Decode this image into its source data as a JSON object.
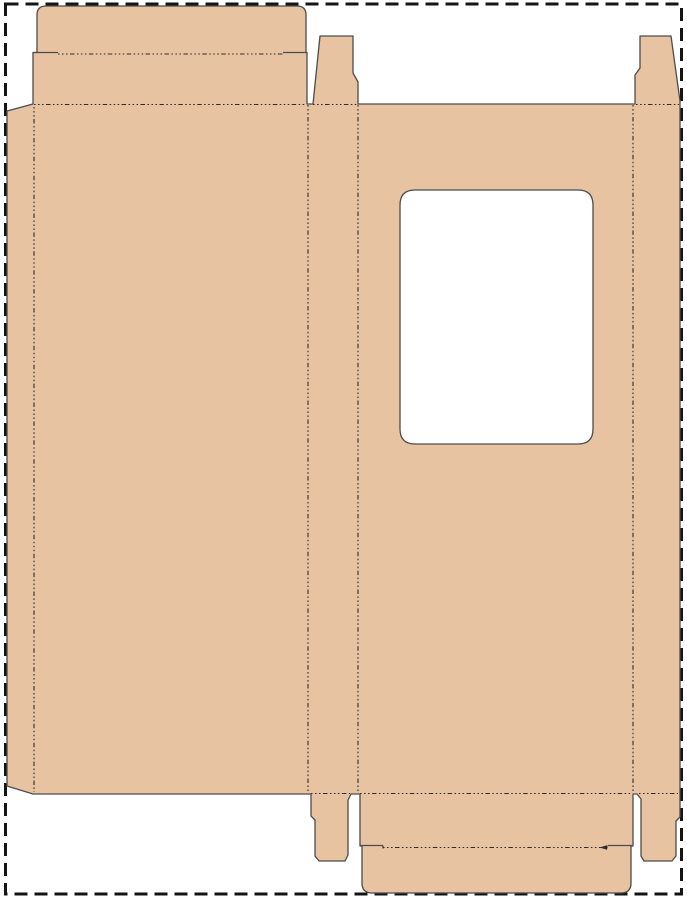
{
  "canvas": {
    "width": 687,
    "height": 900,
    "background_color": "#ffffff"
  },
  "palette": {
    "board_fill": "#e8c3a2",
    "cut_line": "#4c4c4c",
    "fold_line": "#2d2d2d",
    "page_border": "#141414",
    "window_fill": "#ffffff"
  },
  "page_border": {
    "x": 5.5,
    "y": 4,
    "width": 676,
    "height": 890,
    "stroke_width": 3,
    "dash_pattern": "13 7"
  },
  "dieline": {
    "outline_path": "M7,111 L33,104 L33,52.5 L37,52.5 L37,15 Q37,6 46,6 L297,6 Q306,6 306,15 L306,52.5 L307,52.5 L307,104 L313,104 L320,36 L353,36 L353,73 L358,82 L358,104 L635,104 L635,75 L640,68 L640,36 L671,36 L680,101 L680,817 L676,821 L676,856 L672,861 L644,861 L641,856 L641,799 L637,794 L633,794 L633,846 L631,846 L631,883 Q631,893 621,893 L372,893 Q362,893 362,883 L362,846 L360,846 L360,794 L351,794 L348,800 L348,855 L345,861 L319,861 L315,856 L315,820 L311,816 L311,794 L33,794 L7,786 Z",
    "window_cutout": {
      "x": 400,
      "y": 190,
      "width": 193,
      "height": 254,
      "corner_radius": 15
    },
    "cut_stroke_width": 1.3,
    "fold_stroke_width": 1.1,
    "fold_dash_pattern": "1.6 2.4 1.6 2.4 1.6 2.4 4.5 2.4",
    "cut_segments": [
      {
        "name": "tuck-top-left-shoulder",
        "d": "M33,52.5 H58"
      },
      {
        "name": "tuck-top-right-shoulder",
        "d": "M283,52.5 H306"
      },
      {
        "name": "tuck-bottom-left-ear",
        "d": "M360,845.5 H383"
      },
      {
        "name": "tuck-bottom-right-ear",
        "d": "M608,845.5 H632"
      },
      {
        "name": "tuck-bottom-left-tick",
        "d": "M383,845.5 V848.5"
      },
      {
        "name": "tuck-bottom-right-tick",
        "d": "M607,845.5 V848.5"
      }
    ],
    "fold_lines": [
      {
        "name": "glue-flap-fold",
        "d": "M34,107 V792"
      },
      {
        "name": "back-left-side-fold",
        "d": "M308,105 V792"
      },
      {
        "name": "left-side-front-fold",
        "d": "M358,105 V792"
      },
      {
        "name": "front-right-side-fold",
        "d": "M633,105 V792"
      },
      {
        "name": "top-tuck-flap-fold",
        "d": "M58,54 H283"
      },
      {
        "name": "back-top-lid-fold",
        "d": "M34,104.5 H306"
      },
      {
        "name": "top-left-dust-flap-fold",
        "d": "M313,104.5 H357"
      },
      {
        "name": "top-right-dust-flap-fold",
        "d": "M636,104.5 H679"
      },
      {
        "name": "front-bottom-lid-fold",
        "d": "M360,793.5 H632"
      },
      {
        "name": "bottom-left-dust-flap-fold",
        "d": "M311,793.5 H350"
      },
      {
        "name": "bottom-right-dust-flap-fold",
        "d": "M639,793.5 H678"
      },
      {
        "name": "bottom-tuck-flap-fold",
        "d": "M383,847.5 H607"
      }
    ],
    "fold_end_arrow": {
      "d": "M607,845.2 L599.5,847.5 L607,849.8 Z"
    },
    "panels": [
      {
        "name": "glue-flap",
        "x": 7,
        "y": 104,
        "width": 27,
        "height": 690
      },
      {
        "name": "back-panel",
        "x": 34,
        "y": 104,
        "width": 274,
        "height": 690
      },
      {
        "name": "left-side-panel",
        "x": 308,
        "y": 104,
        "width": 50,
        "height": 690
      },
      {
        "name": "front-panel",
        "x": 358,
        "y": 104,
        "width": 275,
        "height": 690
      },
      {
        "name": "right-side-panel",
        "x": 633,
        "y": 104,
        "width": 47,
        "height": 690
      },
      {
        "name": "top-lid-panel",
        "x": 33,
        "y": 52,
        "width": 274,
        "height": 52
      },
      {
        "name": "top-tuck-flap",
        "x": 37,
        "y": 6,
        "width": 269,
        "height": 46
      },
      {
        "name": "top-left-dust-flap",
        "x": 313,
        "y": 36,
        "width": 45,
        "height": 68
      },
      {
        "name": "top-right-dust-flap",
        "x": 635,
        "y": 36,
        "width": 45,
        "height": 68
      },
      {
        "name": "bottom-lid-panel",
        "x": 360,
        "y": 794,
        "width": 273,
        "height": 52
      },
      {
        "name": "bottom-tuck-flap",
        "x": 362,
        "y": 846,
        "width": 269,
        "height": 47
      },
      {
        "name": "bottom-left-dust-flap",
        "x": 311,
        "y": 794,
        "width": 40,
        "height": 67
      },
      {
        "name": "bottom-right-dust-flap",
        "x": 637,
        "y": 794,
        "width": 43,
        "height": 67
      }
    ]
  }
}
